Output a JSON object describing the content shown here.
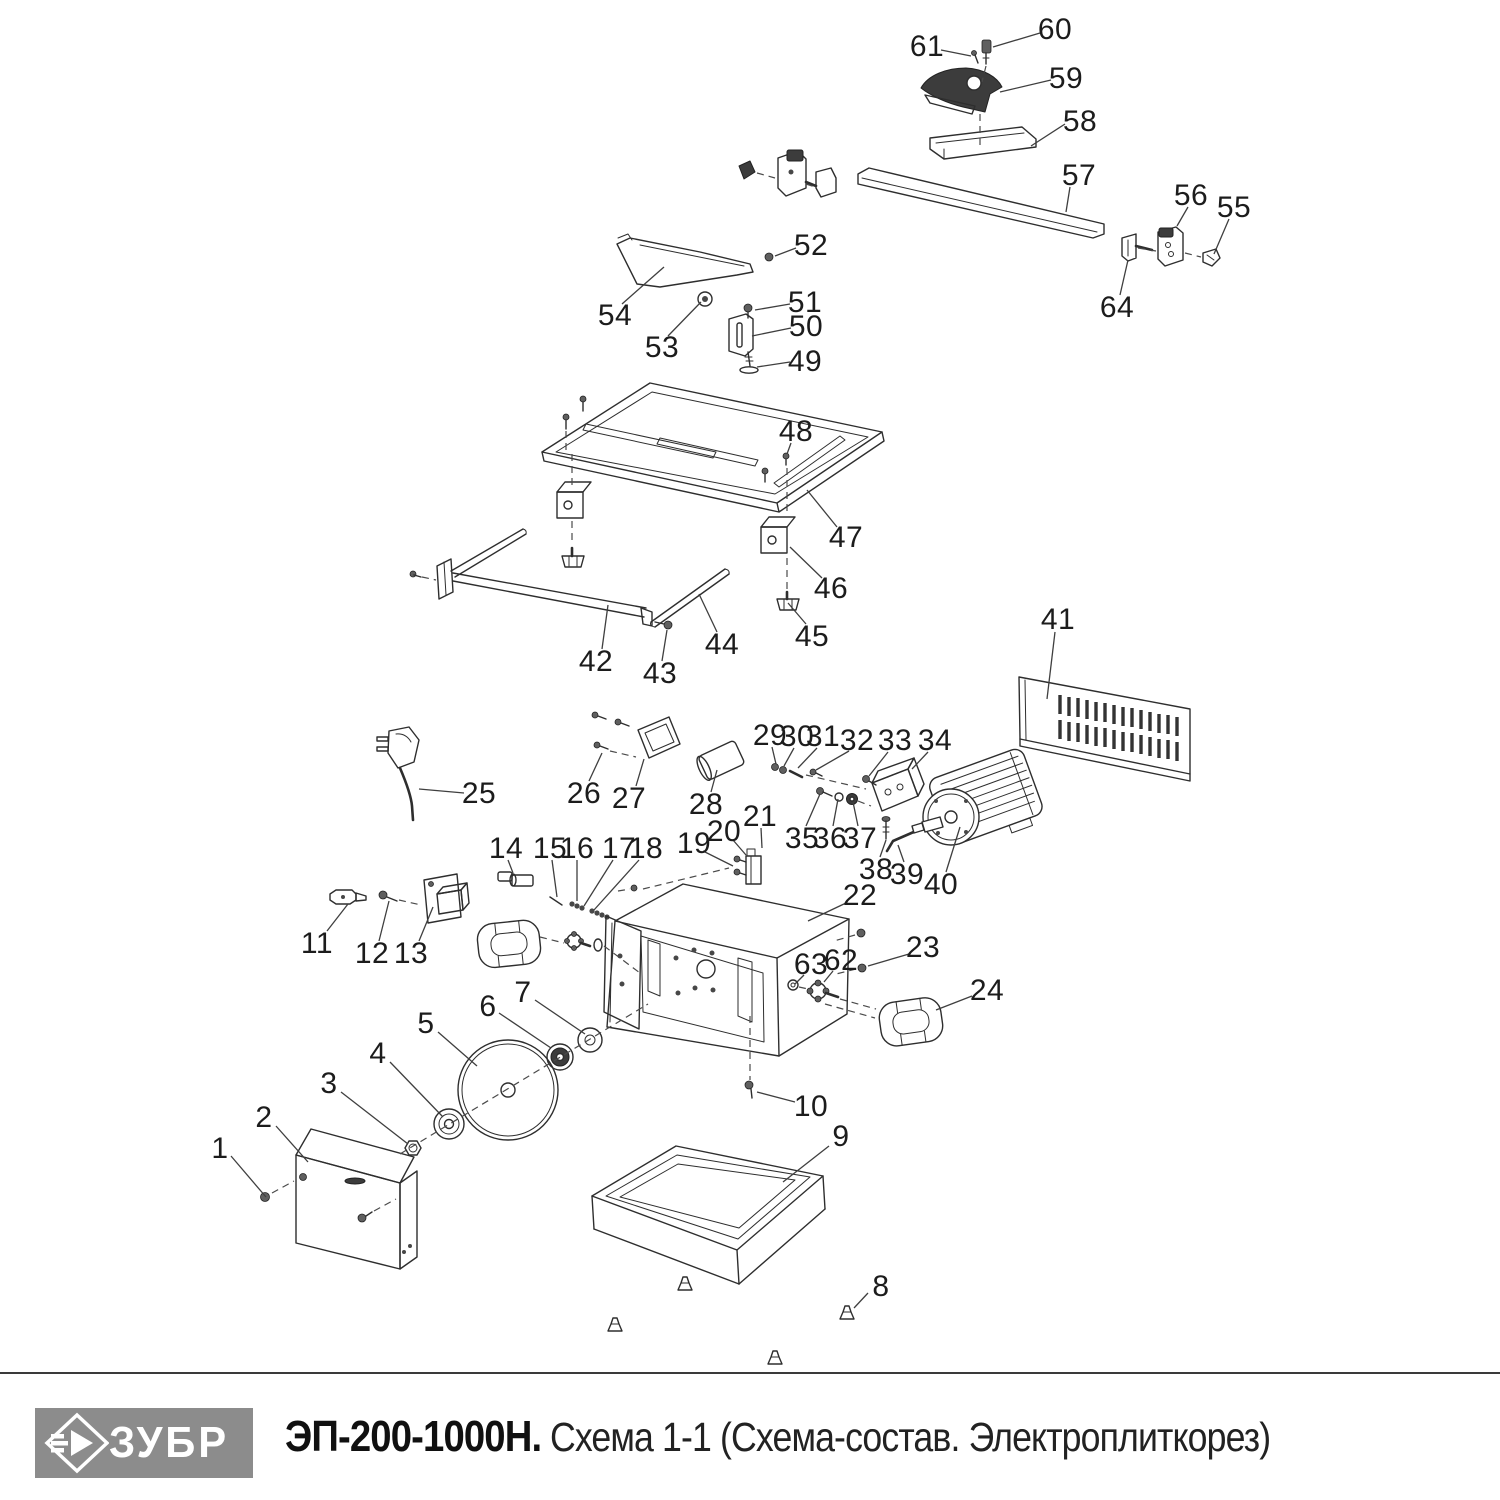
{
  "theme": {
    "ink": "#2e2e2e",
    "leader": "#3f3f3f",
    "label": "#1c1c1c",
    "logo_bg": "#8c8c8c",
    "logo_fg": "#ffffff"
  },
  "footer": {
    "logo_text": "ЗУБР",
    "model": "ЭП-200-1000Н.",
    "scheme": "Схема 1-1 (Схема-состав. Электроплиткорез)"
  },
  "diagram": {
    "labels": [
      {
        "n": "1",
        "x": 220,
        "y": 1148,
        "l": [
          231,
          1156,
          266,
          1197
        ]
      },
      {
        "n": "2",
        "x": 264,
        "y": 1117,
        "l": [
          276,
          1126,
          308,
          1162
        ]
      },
      {
        "n": "3",
        "x": 329,
        "y": 1083,
        "l": [
          341,
          1092,
          408,
          1144
        ]
      },
      {
        "n": "4",
        "x": 378,
        "y": 1053,
        "l": [
          390,
          1062,
          443,
          1117
        ]
      },
      {
        "n": "5",
        "x": 426,
        "y": 1023,
        "l": [
          438,
          1032,
          477,
          1066
        ]
      },
      {
        "n": "6",
        "x": 488,
        "y": 1006,
        "l": [
          499,
          1013,
          551,
          1048
        ]
      },
      {
        "n": "7",
        "x": 523,
        "y": 992,
        "l": [
          535,
          1000,
          585,
          1034
        ]
      },
      {
        "n": "8",
        "x": 881,
        "y": 1286,
        "l": [
          868,
          1293,
          854,
          1308
        ]
      },
      {
        "n": "9",
        "x": 841,
        "y": 1136,
        "l": [
          829,
          1146,
          783,
          1182
        ]
      },
      {
        "n": "10",
        "x": 811,
        "y": 1106,
        "l": [
          795,
          1102,
          757,
          1092
        ]
      },
      {
        "n": "11",
        "x": 317,
        "y": 943,
        "l": [
          327,
          931,
          348,
          904
        ]
      },
      {
        "n": "12",
        "x": 372,
        "y": 953,
        "l": [
          379,
          941,
          389,
          901
        ]
      },
      {
        "n": "13",
        "x": 411,
        "y": 953,
        "l": [
          419,
          941,
          433,
          907
        ]
      },
      {
        "n": "14",
        "x": 506,
        "y": 848,
        "l": [
          508,
          860,
          513,
          873
        ]
      },
      {
        "n": "15",
        "x": 550,
        "y": 848,
        "l": [
          552,
          860,
          557,
          897
        ]
      },
      {
        "n": "16",
        "x": 577,
        "y": 848,
        "l": [
          577,
          860,
          577,
          901
        ]
      },
      {
        "n": "17",
        "x": 619,
        "y": 848,
        "l": [
          613,
          860,
          584,
          906
        ]
      },
      {
        "n": "18",
        "x": 646,
        "y": 848,
        "l": [
          639,
          860,
          594,
          910
        ]
      },
      {
        "n": "19",
        "x": 694,
        "y": 843,
        "l": [
          703,
          851,
          733,
          866
        ]
      },
      {
        "n": "20",
        "x": 724,
        "y": 831,
        "l": [
          733,
          840,
          746,
          855
        ]
      },
      {
        "n": "21",
        "x": 760,
        "y": 816,
        "l": [
          761,
          828,
          762,
          848
        ]
      },
      {
        "n": "22",
        "x": 860,
        "y": 895,
        "l": [
          846,
          903,
          808,
          921
        ]
      },
      {
        "n": "23",
        "x": 923,
        "y": 947,
        "l": [
          909,
          954,
          868,
          966
        ]
      },
      {
        "n": "24",
        "x": 987,
        "y": 990,
        "l": [
          972,
          996,
          936,
          1010
        ]
      },
      {
        "n": "25",
        "x": 479,
        "y": 793,
        "l": [
          464,
          793,
          419,
          789
        ]
      },
      {
        "n": "26",
        "x": 584,
        "y": 793,
        "l": [
          589,
          781,
          602,
          753
        ]
      },
      {
        "n": "27",
        "x": 629,
        "y": 798,
        "l": [
          636,
          786,
          644,
          759
        ]
      },
      {
        "n": "28",
        "x": 706,
        "y": 804,
        "l": [
          711,
          792,
          717,
          770
        ]
      },
      {
        "n": "29",
        "x": 770,
        "y": 735,
        "l": [
          772,
          747,
          776,
          764
        ]
      },
      {
        "n": "30",
        "x": 797,
        "y": 736,
        "l": [
          794,
          748,
          784,
          766
        ]
      },
      {
        "n": "31",
        "x": 823,
        "y": 736,
        "l": [
          817,
          748,
          798,
          768
        ]
      },
      {
        "n": "32",
        "x": 857,
        "y": 740,
        "l": [
          849,
          751,
          816,
          770
        ]
      },
      {
        "n": "33",
        "x": 895,
        "y": 740,
        "l": [
          888,
          752,
          869,
          776
        ]
      },
      {
        "n": "34",
        "x": 935,
        "y": 740,
        "l": [
          928,
          752,
          912,
          769
        ]
      },
      {
        "n": "35",
        "x": 802,
        "y": 838,
        "l": [
          806,
          826,
          820,
          794
        ]
      },
      {
        "n": "36",
        "x": 830,
        "y": 838,
        "l": [
          833,
          826,
          838,
          799
        ]
      },
      {
        "n": "37",
        "x": 860,
        "y": 838,
        "l": [
          858,
          826,
          853,
          802
        ]
      },
      {
        "n": "38",
        "x": 876,
        "y": 869,
        "l": [
          880,
          857,
          886,
          840
        ]
      },
      {
        "n": "39",
        "x": 907,
        "y": 874,
        "l": [
          904,
          862,
          898,
          845
        ]
      },
      {
        "n": "40",
        "x": 941,
        "y": 884,
        "l": [
          946,
          872,
          960,
          827
        ]
      },
      {
        "n": "41",
        "x": 1058,
        "y": 619,
        "l": [
          1055,
          632,
          1047,
          699
        ]
      },
      {
        "n": "42",
        "x": 596,
        "y": 661,
        "l": [
          602,
          649,
          608,
          605
        ]
      },
      {
        "n": "43",
        "x": 660,
        "y": 673,
        "l": [
          662,
          661,
          667,
          630
        ]
      },
      {
        "n": "44",
        "x": 722,
        "y": 644,
        "l": [
          717,
          632,
          699,
          594
        ]
      },
      {
        "n": "45",
        "x": 812,
        "y": 636,
        "l": [
          806,
          624,
          788,
          603
        ]
      },
      {
        "n": "46",
        "x": 831,
        "y": 588,
        "l": [
          822,
          578,
          790,
          547
        ]
      },
      {
        "n": "47",
        "x": 846,
        "y": 537,
        "l": [
          837,
          527,
          807,
          490
        ]
      },
      {
        "n": "48",
        "x": 796,
        "y": 431,
        "l": [
          791,
          443,
          787,
          454
        ]
      },
      {
        "n": "49",
        "x": 805,
        "y": 361,
        "l": [
          790,
          362,
          757,
          367
        ]
      },
      {
        "n": "50",
        "x": 806,
        "y": 326,
        "l": [
          791,
          328,
          752,
          336
        ]
      },
      {
        "n": "51",
        "x": 805,
        "y": 302,
        "l": [
          790,
          304,
          755,
          310
        ]
      },
      {
        "n": "52",
        "x": 811,
        "y": 245,
        "l": [
          796,
          248,
          775,
          256
        ]
      },
      {
        "n": "53",
        "x": 662,
        "y": 347,
        "l": [
          668,
          336,
          701,
          302
        ]
      },
      {
        "n": "54",
        "x": 615,
        "y": 315,
        "l": [
          622,
          304,
          664,
          267
        ]
      },
      {
        "n": "55",
        "x": 1234,
        "y": 207,
        "l": [
          1229,
          219,
          1214,
          254
        ]
      },
      {
        "n": "56",
        "x": 1191,
        "y": 195,
        "l": [
          1188,
          207,
          1177,
          226
        ]
      },
      {
        "n": "57",
        "x": 1079,
        "y": 175,
        "l": [
          1070,
          187,
          1066,
          212
        ]
      },
      {
        "n": "58",
        "x": 1080,
        "y": 121,
        "l": [
          1065,
          124,
          1031,
          146
        ]
      },
      {
        "n": "59",
        "x": 1066,
        "y": 78,
        "l": [
          1051,
          80,
          1000,
          92
        ]
      },
      {
        "n": "60",
        "x": 1055,
        "y": 29,
        "l": [
          1040,
          33,
          993,
          47
        ]
      },
      {
        "n": "61",
        "x": 927,
        "y": 46,
        "l": [
          941,
          50,
          971,
          56
        ]
      },
      {
        "n": "62",
        "x": 841,
        "y": 960,
        "l": [
          833,
          971,
          824,
          982
        ]
      },
      {
        "n": "63",
        "x": 811,
        "y": 964,
        "l": [
          804,
          975,
          795,
          984
        ]
      },
      {
        "n": "64",
        "x": 1117,
        "y": 307,
        "l": [
          1120,
          295,
          1128,
          260
        ]
      }
    ]
  }
}
